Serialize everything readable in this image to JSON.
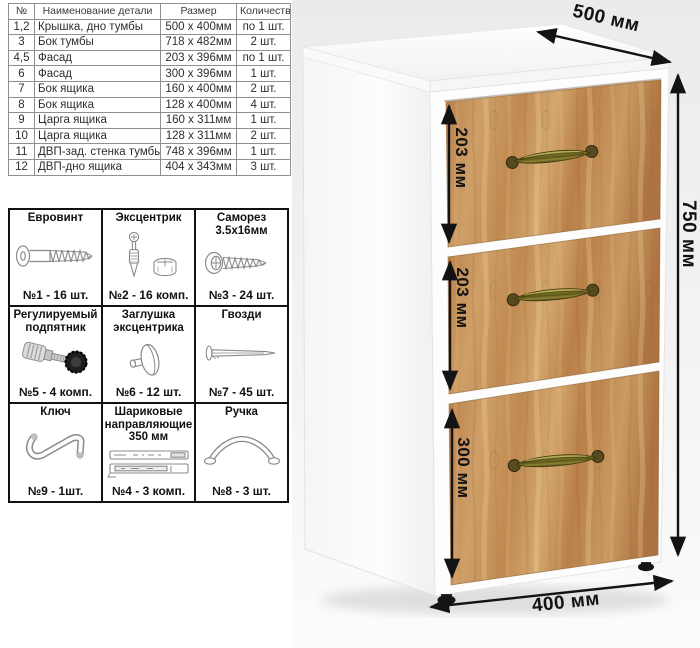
{
  "parts_table": {
    "headers": [
      "№",
      "Наименование детали",
      "Размер",
      "Количество"
    ],
    "rows": [
      [
        "1,2",
        "Крышка, дно тумбы",
        "500 x 400мм",
        "по 1 шт."
      ],
      [
        "3",
        "Бок тумбы",
        "718 x 482мм",
        "2 шт."
      ],
      [
        "4,5",
        "Фасад",
        "203 x 396мм",
        "по 1 шт."
      ],
      [
        "6",
        "Фасад",
        "300 x 396мм",
        "1 шт."
      ],
      [
        "7",
        "Бок ящика",
        "160 x 400мм",
        "2 шт."
      ],
      [
        "8",
        "Бок ящика",
        "128 x 400мм",
        "4 шт."
      ],
      [
        "9",
        "Царга ящика",
        "160 x 311мм",
        "1 шт."
      ],
      [
        "10",
        "Царга ящика",
        "128 x 311мм",
        "2 шт."
      ],
      [
        "11",
        "ДВП-зад. стенка тумбы",
        "748 x 396мм",
        "1 шт."
      ],
      [
        "12",
        "ДВП-дно ящика",
        "404 x 343мм",
        "3 шт."
      ]
    ]
  },
  "hardware": {
    "items": [
      {
        "name": "Евровинт",
        "count": "№1 - 16 шт.",
        "icon": "euro-screw"
      },
      {
        "name": "Эксцентрик",
        "count": "№2 - 16 комп.",
        "icon": "cam-lock"
      },
      {
        "name": "Саморез 3.5x16мм",
        "count": "№3 - 24 шт.",
        "icon": "self-tapping-screw"
      },
      {
        "name": "Регулируемый подпятник",
        "count": "№5 - 4 комп.",
        "icon": "adjustable-foot"
      },
      {
        "name": "Заглушка эксцентрика",
        "count": "№6 - 12 шт.",
        "icon": "cam-cap"
      },
      {
        "name": "Гвозди",
        "count": "№7 - 45 шт.",
        "icon": "nail"
      },
      {
        "name": "Ключ",
        "count": "№9 - 1шт.",
        "icon": "hex-key"
      },
      {
        "name": "Шариковые направляющие 350 мм",
        "count": "№4 - 3 комп.",
        "icon": "ball-slides"
      },
      {
        "name": "Ручка",
        "count": "№8 - 3 шт.",
        "icon": "handle"
      }
    ]
  },
  "cabinet": {
    "dimensions": {
      "depth": "500 мм",
      "height": "750 мм",
      "width": "400 мм",
      "drawer_top": "203 мм",
      "drawer_middle": "203 мм",
      "drawer_bottom": "300 мм"
    },
    "colors": {
      "wood": "#c3935c",
      "handle_brass": "#7e7627",
      "carcass": "#ffffff",
      "dimension_text": "#131313"
    }
  }
}
